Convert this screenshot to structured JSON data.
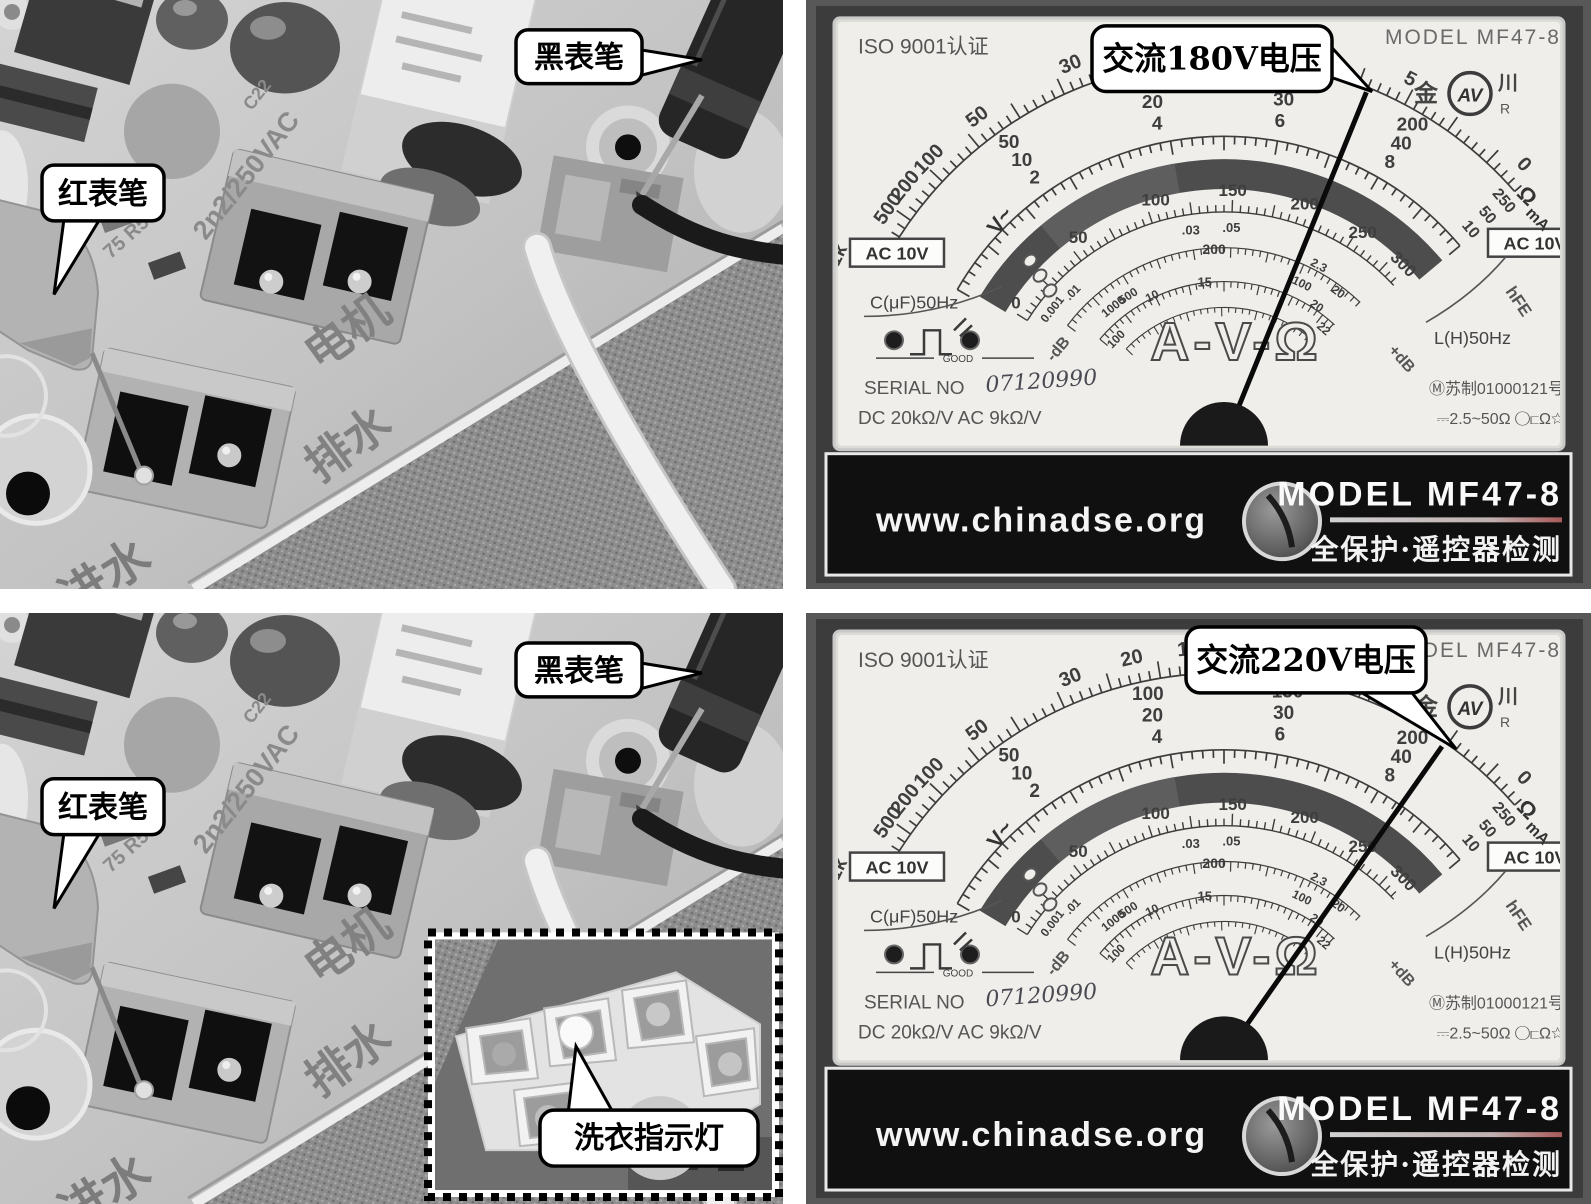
{
  "figure": {
    "description_rows": 2,
    "description_cols": 2
  },
  "photos": {
    "black_probe_label": "黑表笔",
    "red_probe_label": "红表笔",
    "inset_label": "洗衣指示灯",
    "board": {
      "cap_value": "2n2/250VAC",
      "cap_ref": "C22",
      "res_ref": "75 R5",
      "motor": "电机",
      "drain": "排水",
      "inlet": "进水"
    }
  },
  "meters": {
    "shared": {
      "iso_label": "ISO 9001认证",
      "model_top": "MODEL  MF47-8",
      "brand_left": "金",
      "brand_mid": "AV",
      "brand_right": "川",
      "brand_r": "R",
      "ac10v_badge": "AC 10V",
      "c_scale_label": "C(μF)50Hz",
      "l_scale_label": "L(H)50Hz",
      "good_label": "GOOD",
      "avo": "A-V-Ω",
      "neg_db": "-dB",
      "pos_db": "+dB",
      "hfe": "hFE",
      "ohm_unit": "Ω",
      "ma_unit": "mA",
      "v_unit": "V~",
      "serial_label": "SERIAL NO",
      "serial_value": "07120990",
      "sensitivity": "DC 20kΩ/V AC 9kΩ/V",
      "cert": "Ⓜ苏制01000121号",
      "range_note": "⎓2.5~50Ω ◯⊏Ω☆",
      "website": "www.chinadse.org",
      "model_band": "MODEL  MF47-8",
      "band_caption": "全保护·遥控器检测",
      "scales": {
        "ohm_labels": [
          {
            "t": "500",
            "a": -55
          },
          {
            "t": "200",
            "a": -51
          },
          {
            "t": "100",
            "a": -46
          },
          {
            "t": "50",
            "a": -37
          },
          {
            "t": "30",
            "a": -22
          },
          {
            "t": "20",
            "a": -13
          },
          {
            "t": "15",
            "a": -5
          },
          {
            "t": "10",
            "a": 3
          },
          {
            "t": "5",
            "a": 27
          },
          {
            "t": "0",
            "a": 47
          }
        ],
        "ohm_end_labels": [
          {
            "t": "1k",
            "a": -64
          },
          {
            "t": "4k",
            "a": -67.5
          },
          {
            "t": "∞",
            "a": -71
          }
        ],
        "dcv_stacks": [
          {
            "a": -59,
            "rows": [
              "0"
            ]
          },
          {
            "a": -36,
            "rows": [
              "50",
              "10",
              "2"
            ]
          },
          {
            "a": -12,
            "rows": [
              "100",
              "20",
              "4"
            ]
          },
          {
            "a": 10,
            "rows": [
              "150",
              "30",
              "6"
            ]
          },
          {
            "a": 31,
            "rows": [
              "200",
              "40",
              "8"
            ]
          },
          {
            "a": 49,
            "rows": [
              "250",
              "50",
              "10"
            ]
          }
        ],
        "ac10_labels": [
          {
            "t": "0",
            "a": -57
          },
          {
            "t": "50",
            "a": -36
          },
          {
            "t": "100",
            "a": -16
          },
          {
            "t": "150",
            "a": 2
          },
          {
            "t": "200",
            "a": 19
          },
          {
            "t": "250",
            "a": 34
          },
          {
            "t": "300",
            "a": 45
          }
        ],
        "inner_labels": [
          {
            "t": "0.001",
            "a": -52,
            "r": 214,
            "rot": 1,
            "s": 12
          },
          {
            "t": ".01",
            "a": -45,
            "r": 210,
            "rot": 1,
            "s": 12
          },
          {
            "t": ".03",
            "a": -9,
            "r": 212,
            "rot": 0,
            "s": 13
          },
          {
            "t": ".05",
            "a": 2,
            "r": 212,
            "rot": 0,
            "s": 13
          },
          {
            "t": "200",
            "a": -3,
            "r": 190,
            "rot": 0,
            "s": 14
          },
          {
            "t": "1000",
            "a": -39,
            "r": 172,
            "rot": 1,
            "s": 12
          },
          {
            "t": "500",
            "a": -33,
            "r": 172,
            "rot": 1,
            "s": 12
          },
          {
            "t": "10",
            "a": -26,
            "r": 160,
            "rot": 1,
            "s": 12
          },
          {
            "t": "100",
            "a": -46,
            "r": 146,
            "rot": 1,
            "s": 12
          },
          {
            "t": "15",
            "a": -7,
            "r": 158,
            "rot": 0,
            "s": 13
          },
          {
            "t": "2.3",
            "a": 28,
            "r": 198,
            "rot": 1,
            "s": 12
          },
          {
            "t": "100",
            "a": 26,
            "r": 174,
            "rot": 1,
            "s": 12
          },
          {
            "t": "20",
            "a": 34,
            "r": 162,
            "rot": 1,
            "s": 12
          },
          {
            "t": "20",
            "a": 37,
            "r": 186,
            "rot": 1,
            "s": 12
          },
          {
            "t": "22",
            "a": 41,
            "r": 148,
            "rot": 1,
            "s": 12
          }
        ]
      }
    },
    "top": {
      "callout": "交流180V电压",
      "needle_angle": 22
    },
    "bottom": {
      "callout": "交流220V电压",
      "needle_angle": 35
    }
  }
}
